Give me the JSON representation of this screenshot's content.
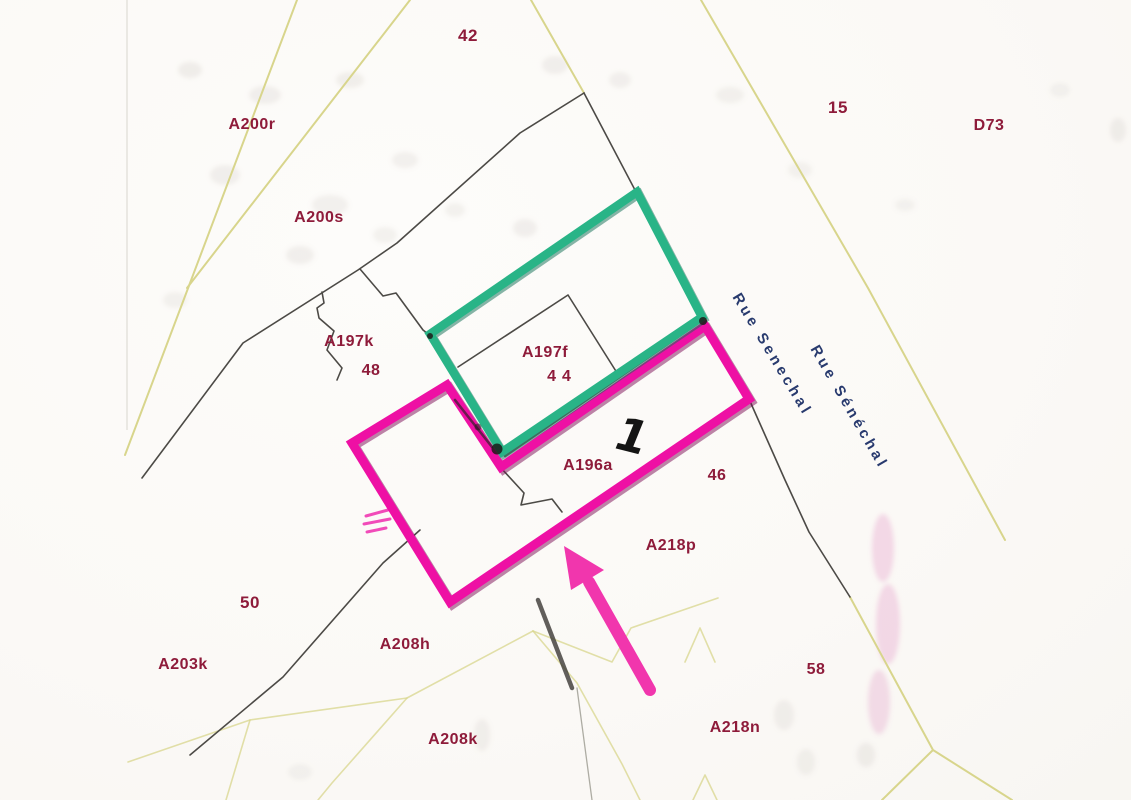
{
  "map": {
    "type": "cadastral-plan",
    "region_labels": [
      {
        "text": "42",
        "x": 468,
        "y": 36,
        "size": 17
      },
      {
        "text": "15",
        "x": 838,
        "y": 108,
        "size": 17
      },
      {
        "text": "D73",
        "x": 989,
        "y": 126,
        "size": 16
      },
      {
        "text": "A200r",
        "x": 252,
        "y": 125,
        "size": 16
      },
      {
        "text": "A200s",
        "x": 319,
        "y": 218,
        "size": 16
      },
      {
        "text": "A197k",
        "x": 349,
        "y": 342,
        "size": 16
      },
      {
        "text": "48",
        "x": 371,
        "y": 371,
        "size": 16
      },
      {
        "text": "A197f",
        "x": 545,
        "y": 353,
        "size": 16
      },
      {
        "text": "44",
        "x": 562,
        "y": 377,
        "size": 16,
        "spacing": 6
      },
      {
        "text": "A196a",
        "x": 588,
        "y": 466,
        "size": 16
      },
      {
        "text": "46",
        "x": 717,
        "y": 476,
        "size": 16
      },
      {
        "text": "A218p",
        "x": 671,
        "y": 546,
        "size": 16
      },
      {
        "text": "50",
        "x": 250,
        "y": 603,
        "size": 17
      },
      {
        "text": "A203k",
        "x": 183,
        "y": 665,
        "size": 16
      },
      {
        "text": "A208h",
        "x": 405,
        "y": 645,
        "size": 16
      },
      {
        "text": "58",
        "x": 816,
        "y": 670,
        "size": 16
      },
      {
        "text": "A218n",
        "x": 735,
        "y": 728,
        "size": 16
      },
      {
        "text": "A208k",
        "x": 453,
        "y": 740,
        "size": 16
      }
    ],
    "road_labels": [
      {
        "text": "Rue Senechal",
        "x": 736,
        "y": 286,
        "rotation": 59
      },
      {
        "text": "Rue Sénéchal",
        "x": 814,
        "y": 338,
        "rotation": 60
      }
    ],
    "annotation": {
      "plot_number": "1",
      "x": 632,
      "y": 436
    },
    "colors": {
      "highlight_green": "#29b487",
      "highlight_pink": "#ee10a4",
      "arrow_pink": "#f136ad",
      "parcel_label": "#8e1b3a",
      "road_label": "#283a6e",
      "boundary_yellow": "#d8d58c",
      "boundary_dark": "#4c4a46",
      "plot_number": "#141414"
    }
  }
}
